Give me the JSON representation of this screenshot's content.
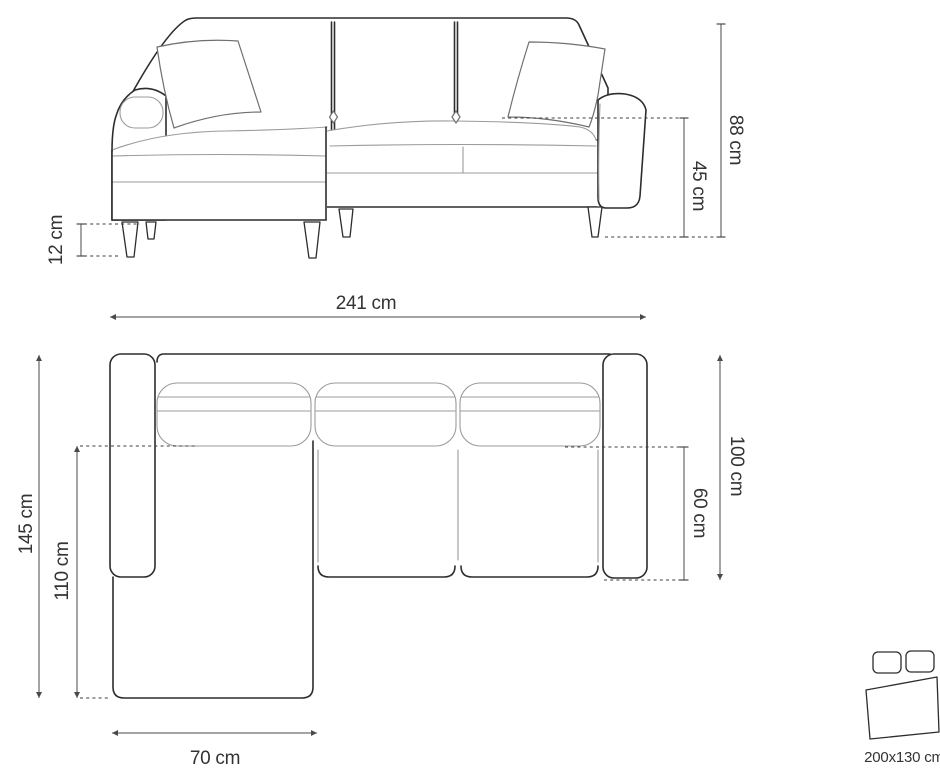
{
  "diagram": {
    "type": "furniture-dimension-diagram",
    "subject": "corner sofa with chaise and sleeping function",
    "front_view": {
      "total_width": "241 cm",
      "total_height": "88 cm",
      "seat_height": "45 cm",
      "leg_height": "12 cm"
    },
    "top_view": {
      "total_depth": "145 cm",
      "chaise_length": "110 cm",
      "body_depth": "100 cm",
      "seat_depth": "60 cm",
      "chaise_width": "70 cm"
    },
    "sleeping_function": {
      "bed_size": "200x130 cm",
      "icon": "sofa-bed-icon"
    },
    "colors": {
      "outline": "#2d2d2d",
      "detail": "#9b9b9b",
      "dimension": "#4a4a4a",
      "label": "#333333",
      "background": "#ffffff"
    }
  }
}
